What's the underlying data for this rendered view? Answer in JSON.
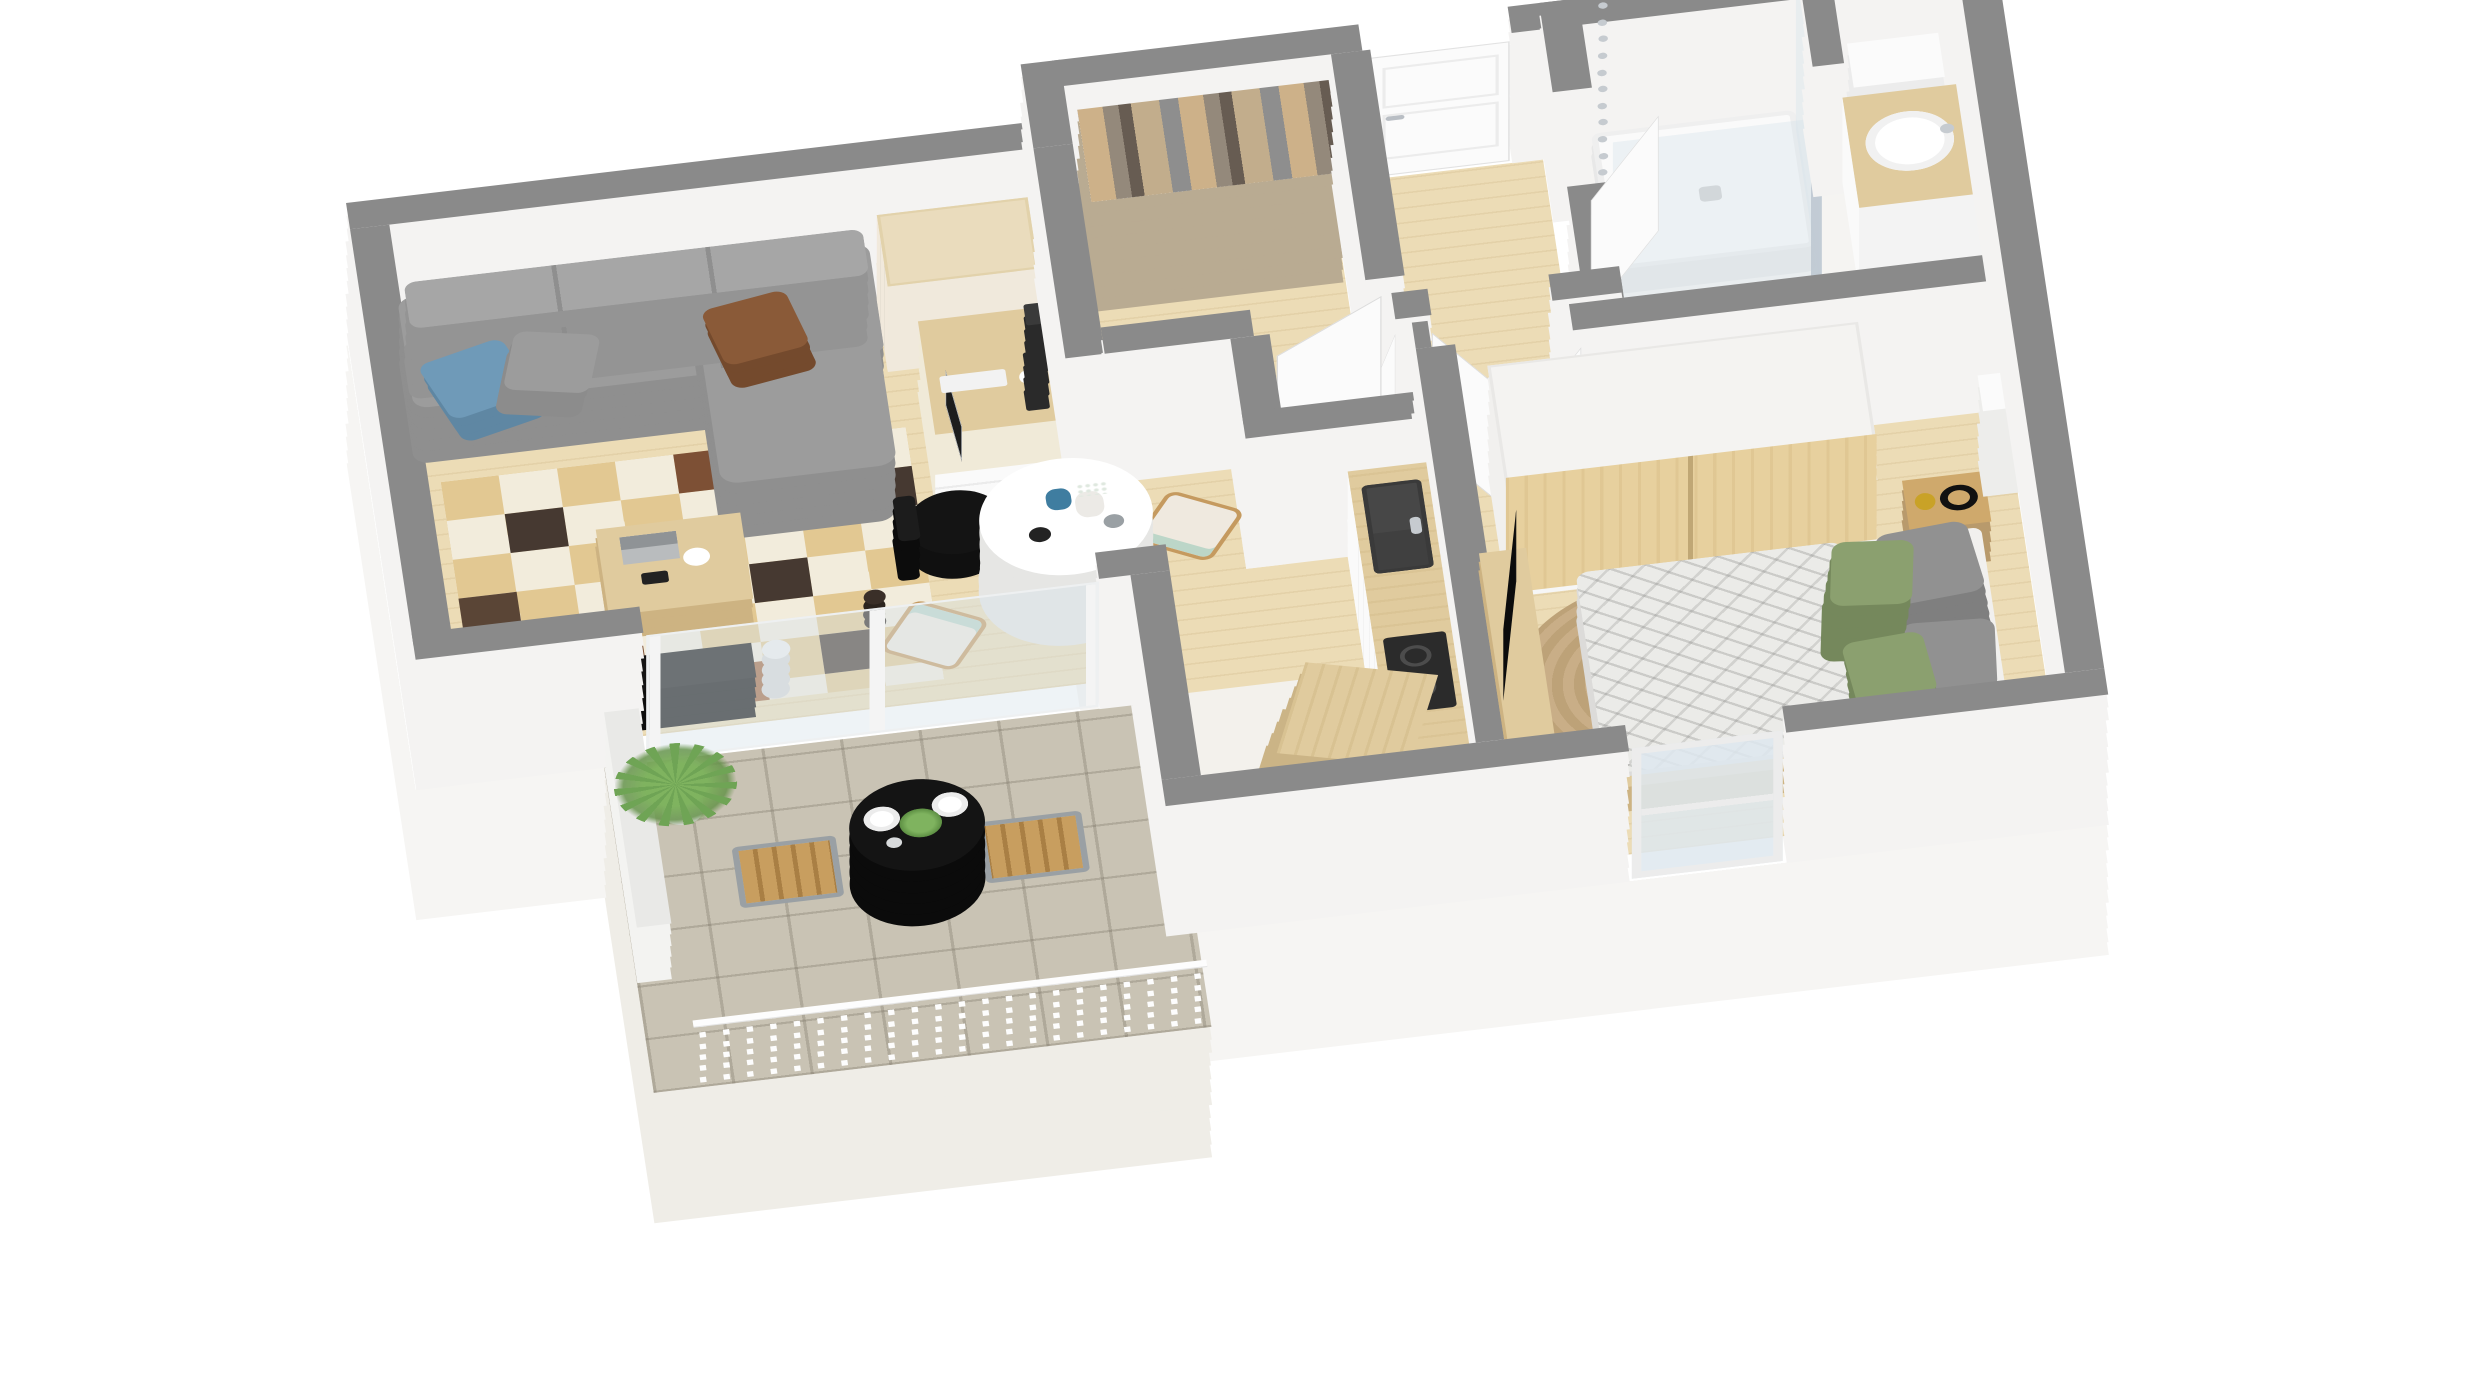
{
  "scene": {
    "type": "3d-isometric-floor-plan-render",
    "description": "Top-down axonometric render of a one-bedroom apartment with balcony",
    "background": "#ffffff",
    "visible_text": []
  },
  "colors": {
    "wall_top": "#8a8a8a",
    "wall_side": "#f4f3f2",
    "slab_side": "#f6f5f3",
    "wood_floor": "#ecdcb6",
    "kitchen_floor": "#f3f1ec",
    "bath_floor": "#f5f4f2",
    "balcony_tile": "#c9c3b4",
    "rug_cream": "#f2ecdc",
    "rug_tan": "#e2c892",
    "rug_brown": "#463931",
    "rug_rust": "#a2673f",
    "sofa_gray": "#9c9c9c",
    "sofa_side": "#8f8f8f",
    "cushion_blue": "#6f9ab8",
    "cushion_gray": "#9c9c9c",
    "cushion_brown": "#8a5a38",
    "furn_wood": "#e0cb9e",
    "furn_wood_side": "#cdb382",
    "door_white": "#fbfbfb",
    "duvet": "#ebebe8",
    "pillow_green": "#8ba06f",
    "pillow_gray": "#919191",
    "jute1": "#c9ae87",
    "jute2": "#bda278",
    "black": "#141414",
    "chrome": "#c6cbd0",
    "sink_dark": "#474747",
    "white_furn": "#fafafa",
    "glass": "rgba(215,228,236,0.40)"
  },
  "rooms": [
    {
      "name": "living-room",
      "floor": "wood",
      "furniture": [
        "corner-sofa",
        "cushion-blue",
        "cushion-gray",
        "cushion-brown",
        "patchwork-rug",
        "coffee-table",
        "laptop",
        "white-vase",
        "camera",
        "tv-sideboard",
        "branch-vase",
        "chest-of-drawers",
        "desk",
        "monitor",
        "keyboard",
        "coffee-machine",
        "office-chair"
      ]
    },
    {
      "name": "dining-area",
      "floor": "wood",
      "furniture": [
        "round-table",
        "blue-vase",
        "white-vase",
        "mugs",
        "dining-chair",
        "dining-chair"
      ]
    },
    {
      "name": "closet-room",
      "floor": "wood",
      "furniture": [
        "clothes-rail",
        "hanging-clothes"
      ]
    },
    {
      "name": "entrance-hall",
      "floor": "wood",
      "furniture": [
        "front-door",
        "open-door",
        "open-door",
        "open-door"
      ]
    },
    {
      "name": "bathroom",
      "floor": "white",
      "furniture": [
        "walk-in-shower",
        "glass-screen",
        "shower-column",
        "partition-wall",
        "cistern-box",
        "vanity-counter",
        "round-basin",
        "faucet",
        "floor-mat"
      ]
    },
    {
      "name": "bedroom",
      "floor": "wood",
      "furniture": [
        "double-bed",
        "patterned-duvet",
        "pillow-gray",
        "pillow-gray",
        "pillow-green",
        "pillow-green",
        "wardrobe",
        "nightstand",
        "headphones",
        "gold-vase",
        "white-lamp-box",
        "round-jute-rug",
        "tv-lowboard",
        "flatscreen-tv",
        "magazines",
        "window"
      ]
    },
    {
      "name": "kitchen",
      "floor": "white",
      "furniture": [
        "counter",
        "inset-sink",
        "faucet",
        "cooktop",
        "oven",
        "island-block"
      ]
    },
    {
      "name": "balcony",
      "floor": "stone-tiles",
      "furniture": [
        "bistro-table",
        "place-setting",
        "place-setting",
        "potted-herb",
        "outdoor-chair",
        "outdoor-chair",
        "planter",
        "railing",
        "sliding-glass-door"
      ],
      "railing_posts": 22
    }
  ]
}
